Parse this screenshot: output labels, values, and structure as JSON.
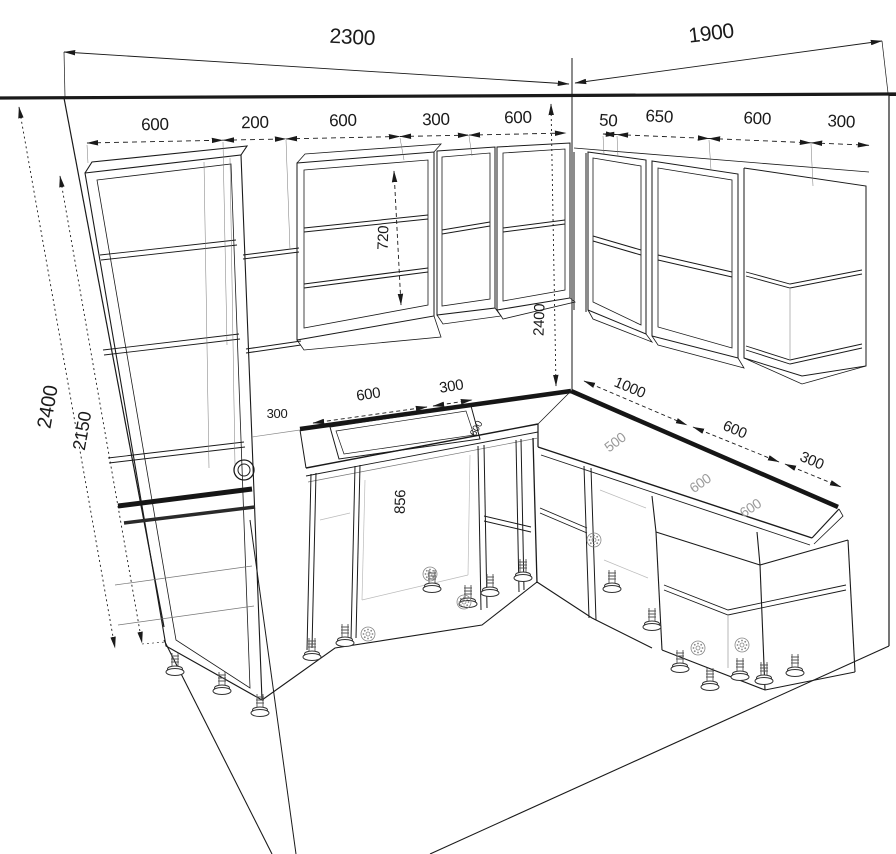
{
  "drawing": {
    "kind": "kitchen-cabinet-perspective-wireframe",
    "background": "#ffffff",
    "ink": "#1a1a1a",
    "faded_label_color": "#9a9a9a"
  },
  "dims": {
    "top": {
      "left_wall": "2300",
      "right_wall": "1900"
    },
    "wall_row_left": [
      "600",
      "200",
      "600",
      "300",
      "600"
    ],
    "wall_row_right": [
      "50",
      "650",
      "600",
      "300"
    ],
    "left_heights": {
      "ceiling": "2400",
      "tall_unit": "2150"
    },
    "counter_left": [
      "600",
      "300"
    ],
    "counter_right": [
      "1000",
      "600",
      "300"
    ],
    "internal": {
      "wall_cab_height": "720",
      "corner_wall_height": "2400",
      "base_height": "856"
    },
    "surface": {
      "counter_depth": "500",
      "base_width_a": "600",
      "base_width_b": "600",
      "hidden_a": "300",
      "hidden_b": "600"
    }
  }
}
